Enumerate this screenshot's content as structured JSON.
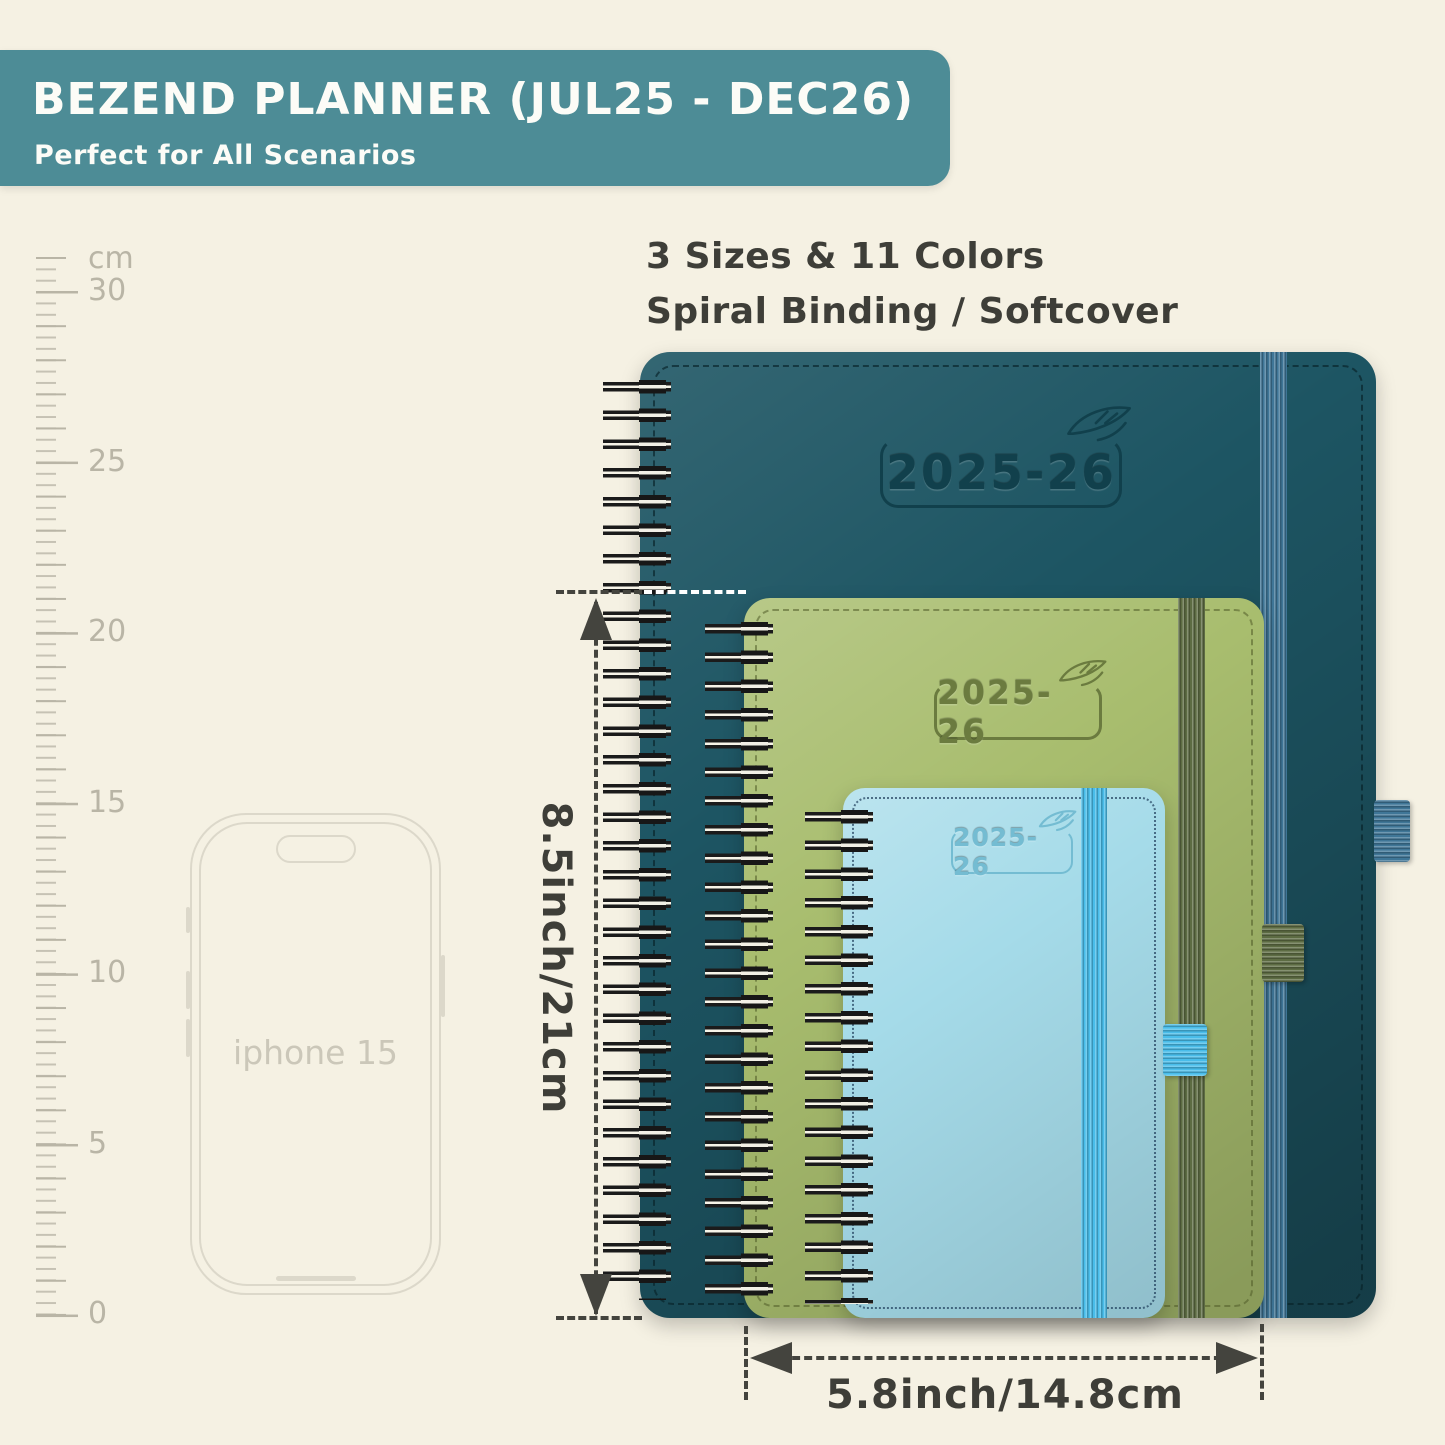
{
  "header": {
    "title": "BEZEND PLANNER (JUL25 - DEC26)",
    "subtitle": "Perfect for All Scenarios"
  },
  "features": {
    "line1": "3 Sizes & 11 Colors",
    "line2": "Spiral Binding / Softcover"
  },
  "ruler": {
    "unit": "cm",
    "marks": [
      "30",
      "25",
      "20",
      "15",
      "10",
      "5",
      "0"
    ]
  },
  "phone": {
    "label": "iphone 15"
  },
  "planners": {
    "large": {
      "year": "2025-26",
      "color_name": "dark teal"
    },
    "medium": {
      "year": "2025-26",
      "color_name": "olive green"
    },
    "small": {
      "year": "2025-26",
      "color_name": "light blue"
    }
  },
  "dimensions": {
    "height": "8.5inch/21cm",
    "width": "5.8inch/14.8cm"
  },
  "colors": {
    "bg": "#f5f1e3",
    "banner": "#4d8c96",
    "banner_text": "#fcfcf7",
    "text_dark": "#3e3e38",
    "ruler": "#b9b5a6",
    "phone_outline": "#dcd8ca",
    "dim_line": "#44443e",
    "teal_cover": "#1d5563",
    "teal_emboss": "#11404c",
    "teal_elastic": "#3f7697",
    "green_cover": "#a8bd6e",
    "green_emboss": "#6b7b3f",
    "green_elastic": "#5d6c43",
    "blue_cover": "#a5dbe9",
    "blue_emboss": "#74bcd2",
    "blue_elastic": "#49bdea"
  }
}
